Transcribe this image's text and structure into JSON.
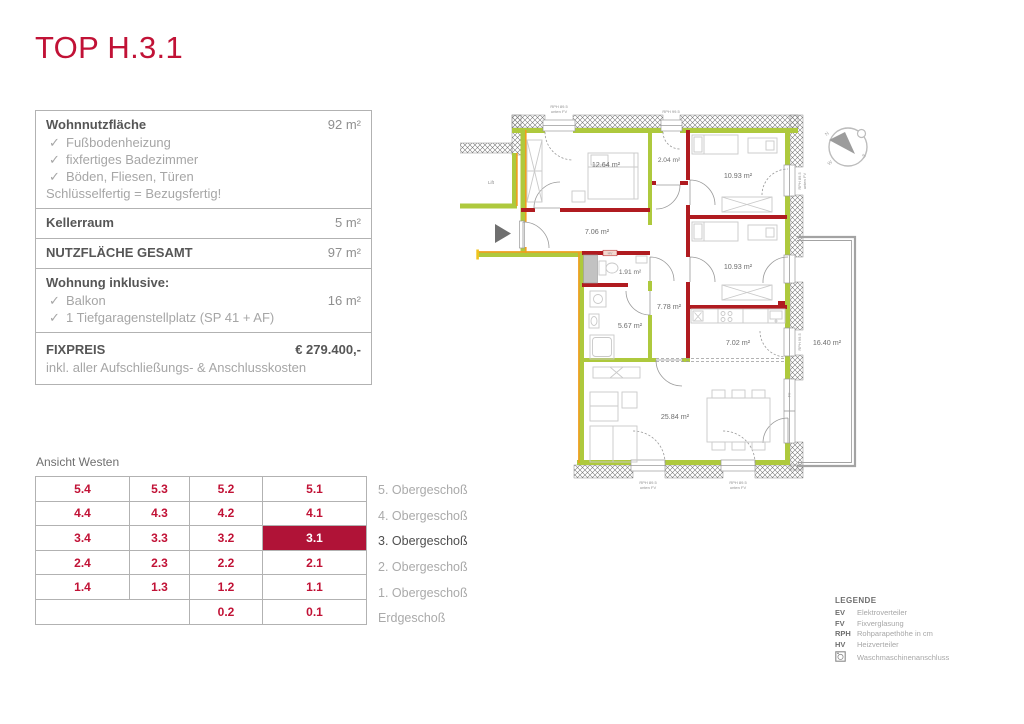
{
  "title": "TOP H.3.1",
  "info": {
    "check": "✓",
    "wohnnutzflaeche_label": "Wohnnutzfläche",
    "wohnnutzflaeche_value": "92 m²",
    "features": [
      "Fußbodenheizung",
      "fixfertiges Badezimmer",
      "Böden, Fliesen, Türen"
    ],
    "note": "Schlüsselfertig = Bezugsfertig!",
    "kellerraum_label": "Kellerraum",
    "kellerraum_value": "5 m²",
    "gesamt_label": "NUTZFLÄCHE GESAMT",
    "gesamt_value": "97 m²",
    "inklusive_label": "Wohnung inklusive:",
    "inklusive_items": [
      {
        "label": "Balkon",
        "value": "16 m²"
      },
      {
        "label": "1 Tiefgaragenstellplatz (SP 41 + AF)",
        "value": ""
      }
    ],
    "fixpreis_label": "FIXPREIS",
    "fixpreis_value": "€ 279.400,-",
    "fixpreis_note": "inkl. aller Aufschließungs- & Anschlusskosten"
  },
  "floor_plan": {
    "rooms": {
      "bedroom1": "12.64 m²",
      "storage": "2.04 m²",
      "bedroom2": "10.93 m²",
      "bedroom3": "10.93 m²",
      "hall": "7.06 m²",
      "wc": "1.91 m²",
      "bath": "5.67 m²",
      "corridor": "7.78 m²",
      "kitchen": "7.02 m²",
      "living": "25.84 m²",
      "balcony": "16.40 m²"
    },
    "labels": {
      "rph895": "RPH 89.5",
      "unten_fv": "unten FV",
      "rph995": "RPH 99.5",
      "fv": "FV",
      "hv": "HV",
      "lift": "Lift"
    },
    "compass": {
      "n": "N",
      "w": "W",
      "s": "S"
    }
  },
  "grid": {
    "title": "Ansicht Westen",
    "rows": [
      {
        "cells": [
          "5.4",
          "5.3",
          "5.2",
          "5.1"
        ],
        "floor": "5. Obergeschoß"
      },
      {
        "cells": [
          "4.4",
          "4.3",
          "4.2",
          "4.1"
        ],
        "floor": "4. Obergeschoß"
      },
      {
        "cells": [
          "3.4",
          "3.3",
          "3.2",
          "3.1"
        ],
        "floor": "3. Obergeschoß"
      },
      {
        "cells": [
          "2.4",
          "2.3",
          "2.2",
          "2.1"
        ],
        "floor": "2. Obergeschoß"
      },
      {
        "cells": [
          "1.4",
          "1.3",
          "1.2",
          "1.1"
        ],
        "floor": "1. Obergeschoß"
      },
      {
        "cells": [
          "",
          "",
          "0.2",
          "0.1"
        ],
        "floor": "Erdgeschoß"
      }
    ],
    "highlighted_unit": "3.1"
  },
  "legend": {
    "title": "LEGENDE",
    "entries": [
      {
        "key": "EV",
        "label": "Elektroverteiler"
      },
      {
        "key": "FV",
        "label": "Fixverglasung"
      },
      {
        "key": "RPH",
        "label": "Rohparapethöhe in cm"
      },
      {
        "key": "HV",
        "label": "Heizverteiler"
      },
      {
        "key": "",
        "label": "Waschmaschinenanschluss"
      }
    ]
  },
  "colors": {
    "accent_red": "#c11236",
    "highlight_bg": "#b01337",
    "wall_green": "#aec93d",
    "wall_orange": "#f09e1e",
    "wall_red": "#b01b20"
  }
}
